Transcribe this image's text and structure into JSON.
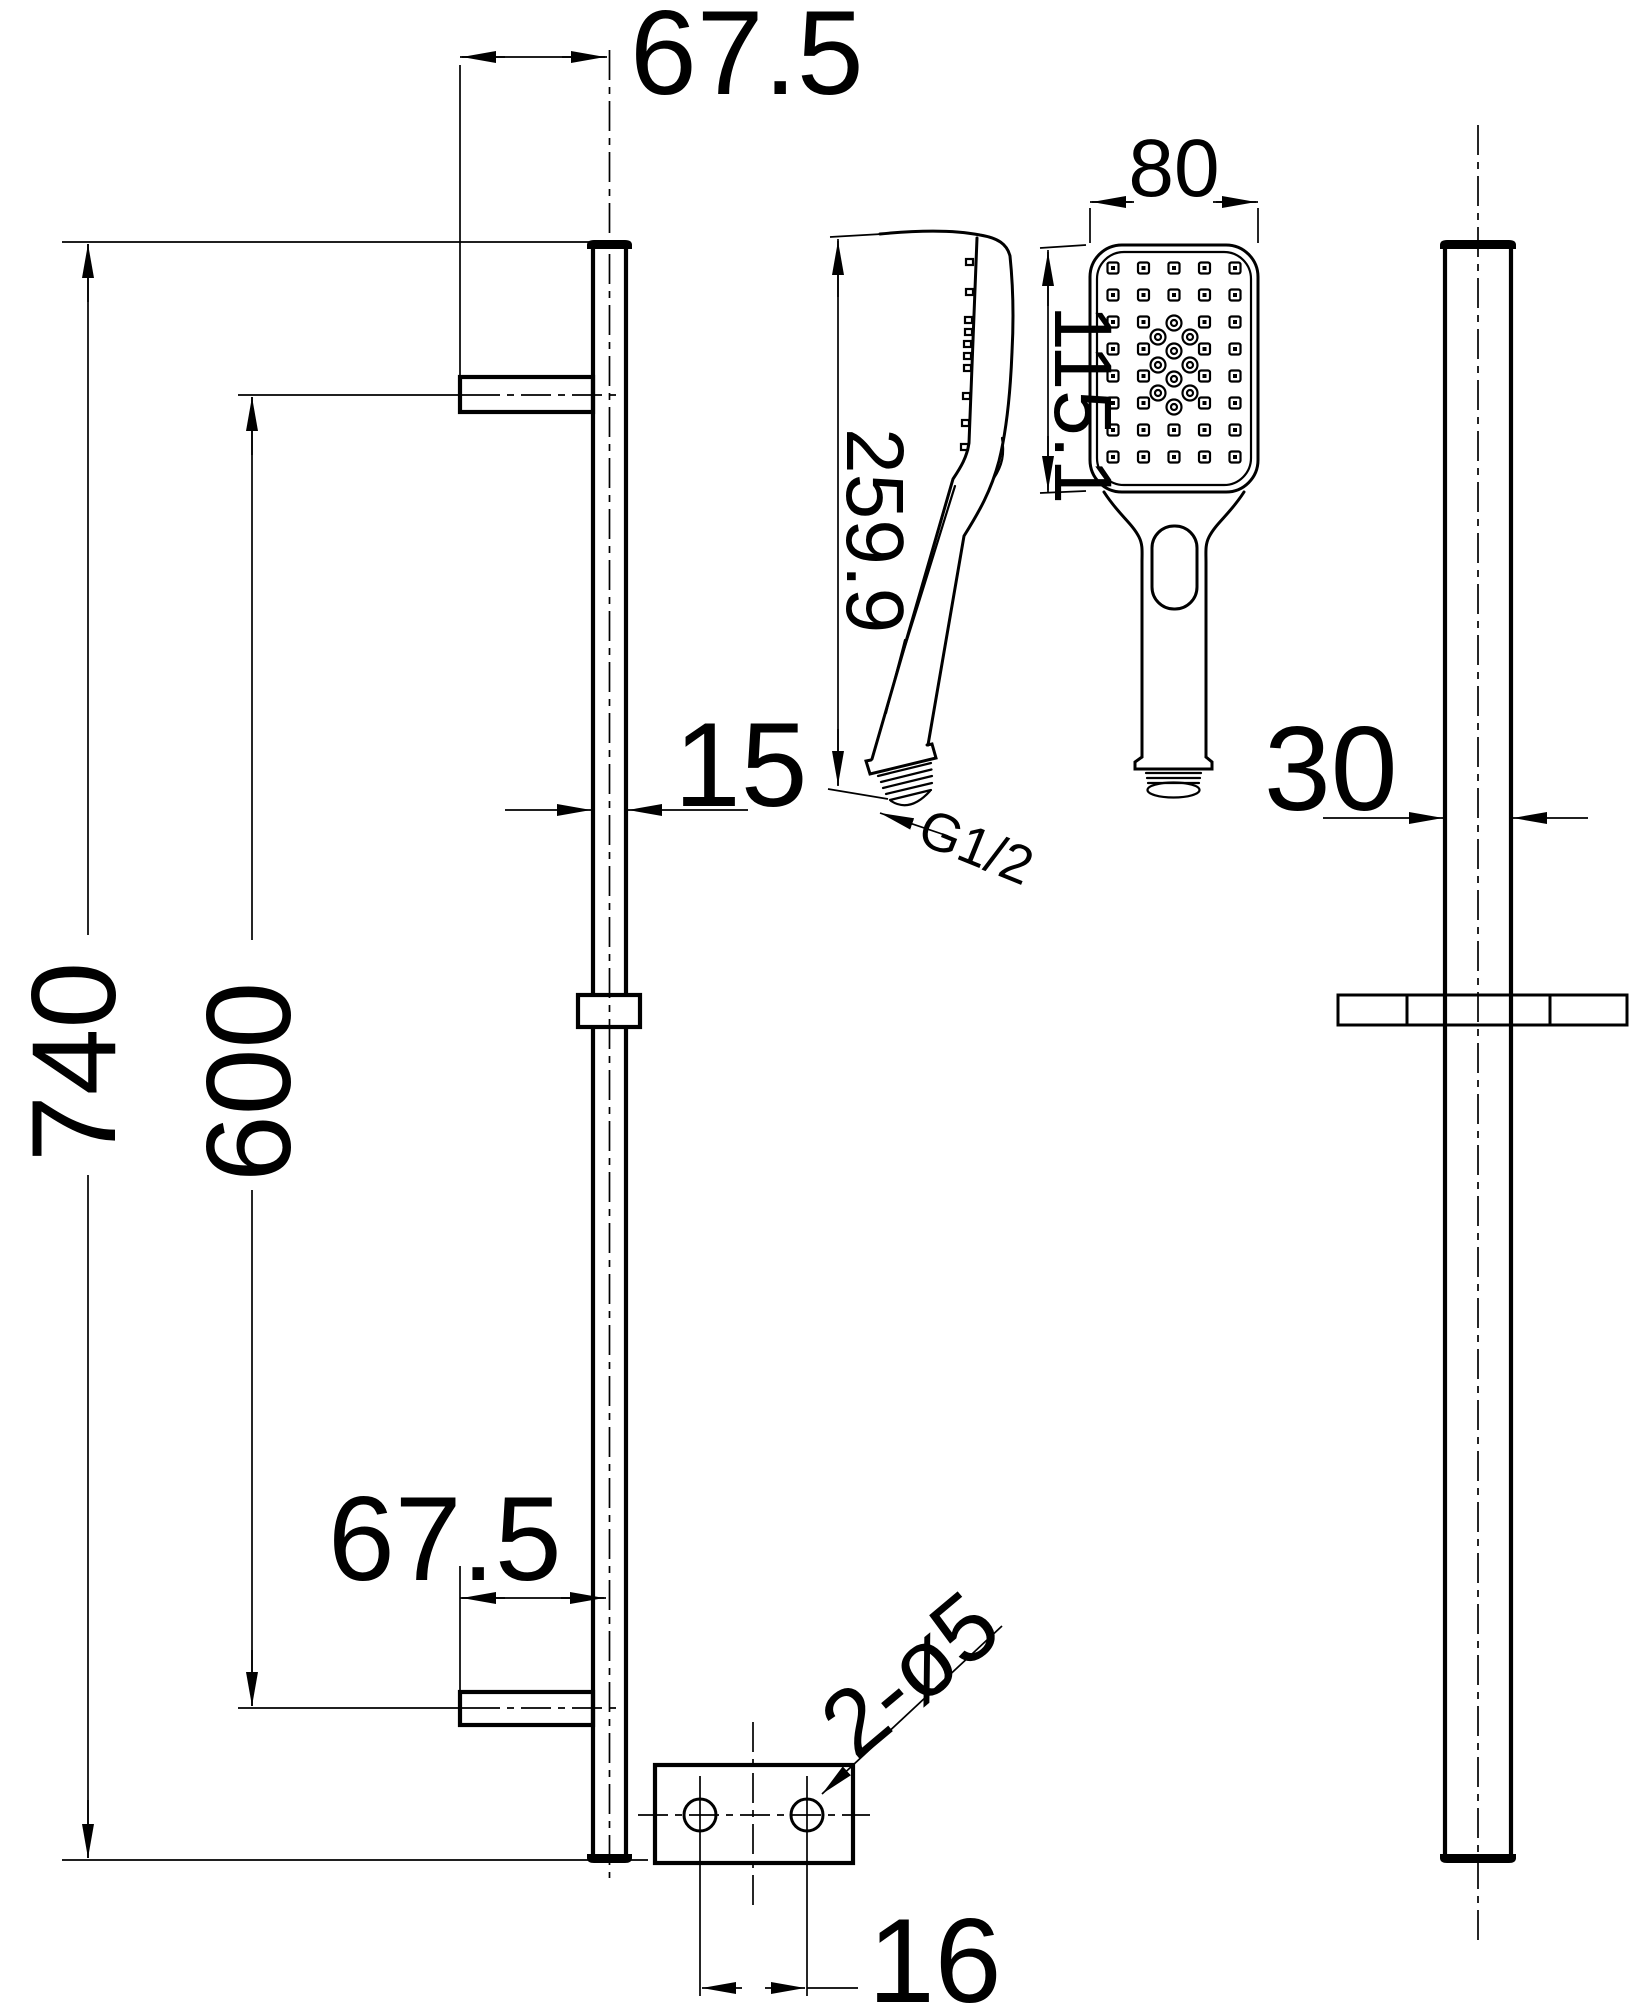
{
  "drawing": {
    "type": "technical-dimension-drawing",
    "subject": "shower slide rail kit with hand shower and wall fixing plate",
    "colors": {
      "line": "#000000",
      "background": "#ffffff"
    },
    "dims": {
      "top_offset": "67.5",
      "total_height": "740",
      "bracket_spacing": "600",
      "bottom_offset": "67.5",
      "rail_width": "15",
      "handset_length": "259.9",
      "thread_size": "G1/2",
      "head_width": "80",
      "face_length": "115.1",
      "rail_depth": "30",
      "hole_spacing": "16",
      "holes_note": "2-ø5"
    }
  }
}
